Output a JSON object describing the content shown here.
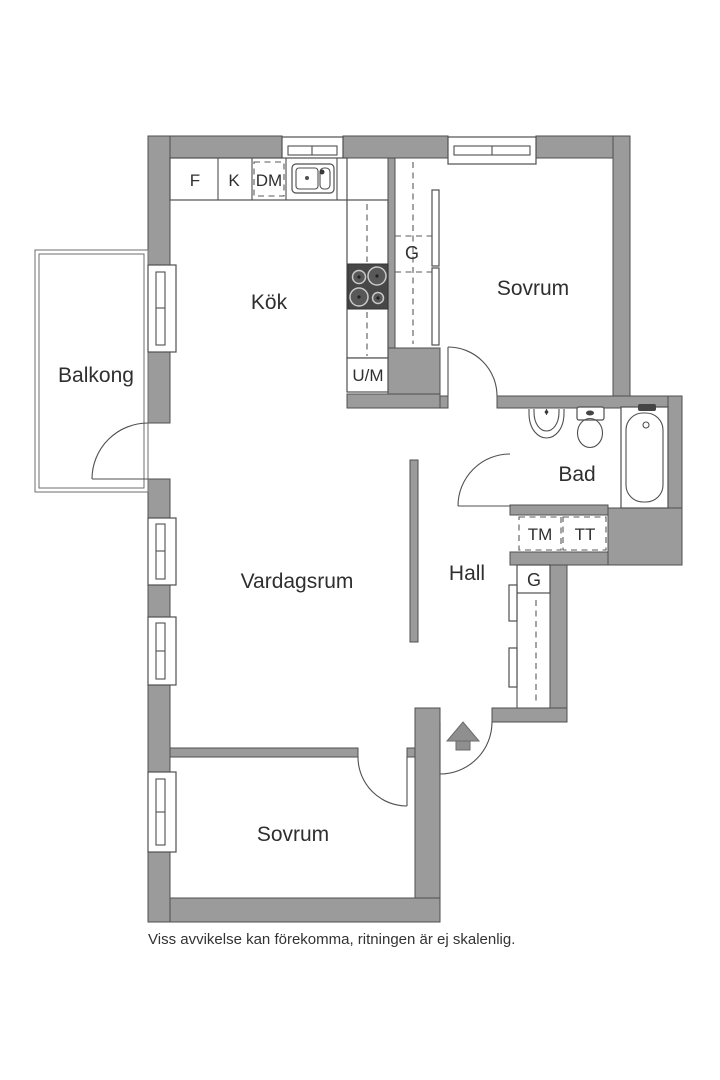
{
  "colors": {
    "wall": "#9b9b9b",
    "wall_outline": "#4f4f4f",
    "line": "#4f4f4f",
    "text": "#2f2f2f",
    "stove": "#474747",
    "arrow": "#8f8f8f"
  },
  "rooms": {
    "balkong": "Balkong",
    "kok": "Kök",
    "sovrum_top": "Sovrum",
    "bad": "Bad",
    "hall": "Hall",
    "vardagsrum": "Vardagsrum",
    "sovrum_bottom": "Sovrum"
  },
  "appliances": {
    "freezer": "F",
    "fridge": "K",
    "dishwasher": "DM",
    "oven_micro": "U/M",
    "washer": "TM",
    "dryer": "TT"
  },
  "closets": {
    "closet_top": "G",
    "closet_hall": "G"
  },
  "footer": {
    "disclaimer": "Viss avvikelse kan förekomma, ritningen är ej skalenlig."
  }
}
